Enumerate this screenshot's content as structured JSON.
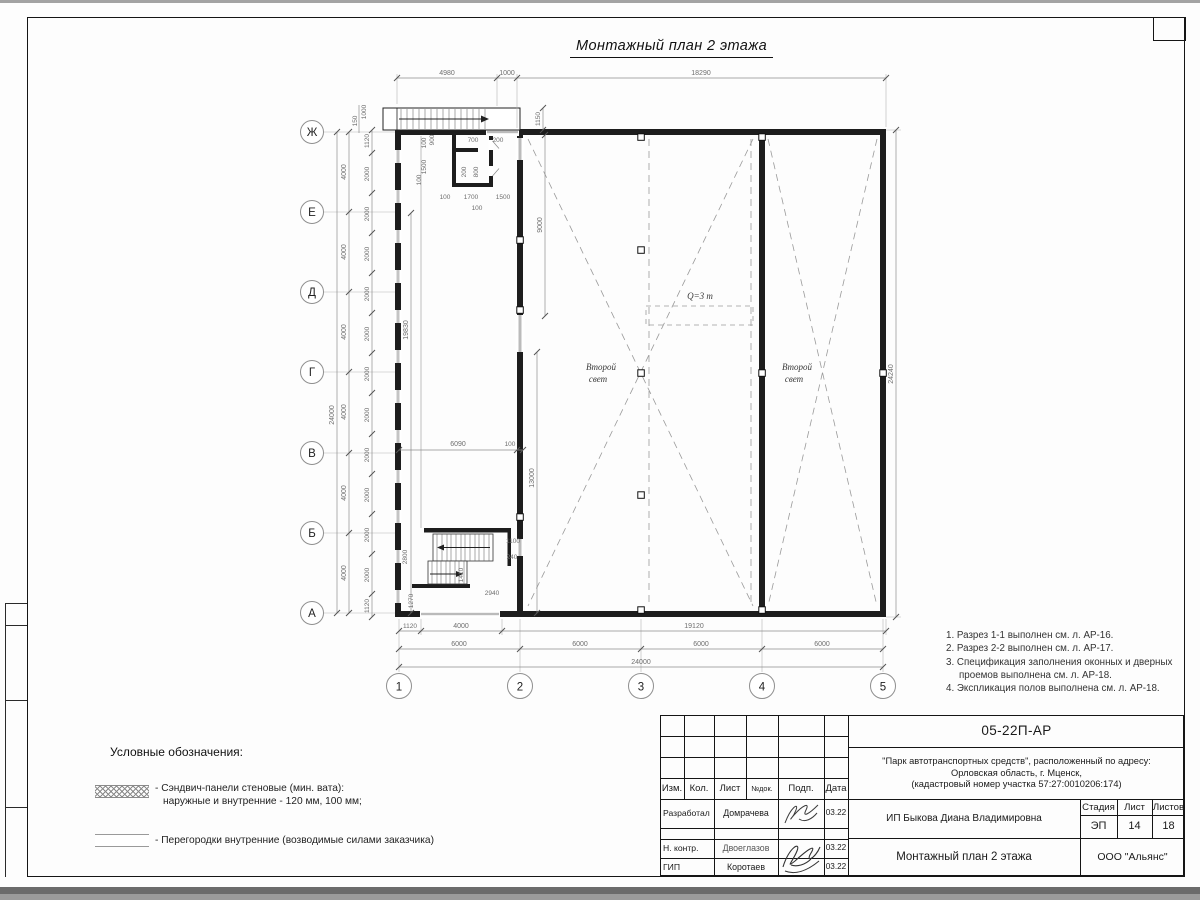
{
  "title": "Монтажный план 2 этажа",
  "notes": {
    "items": [
      "1. Разрез 1-1 выполнен см. л. АР-16.",
      "2. Разрез 2-2 выполнен см. л. АР-17.",
      "3. Спецификация заполнения оконных и дверных проемов выполнена см. л. АР-18.",
      "4. Экспликация полов выполнена см. л. АР-18."
    ]
  },
  "legend": {
    "title": "Условные обозначения:",
    "item1_line1": "- Сэндвич-панели стеновые (мин. вата):",
    "item1_line2": "наружные и внутренние - 120 мм, 100 мм;",
    "item2": "- Перегородки внутренние (возводимые силами заказчика)"
  },
  "plan": {
    "axes": {
      "rows": [
        "Ж",
        "Е",
        "Д",
        "Г",
        "В",
        "Б",
        "А"
      ],
      "cols": [
        "1",
        "2",
        "3",
        "4",
        "5"
      ]
    },
    "labels": {
      "second_light_line1": "Второй",
      "second_light_line2": "свет",
      "crane": "Q=3 т"
    },
    "dims": {
      "d4980": "4980",
      "d1000": "1000",
      "d18290": "18290",
      "d1150": "1150",
      "d150": "150",
      "d24000": "24000",
      "d4000": "4000",
      "d2000": "2000",
      "d1120": "1120",
      "d24240": "24240",
      "d19830": "19830",
      "d9000": "9000",
      "d13000": "13000",
      "d6090": "6090",
      "d100": "100",
      "d900": "900",
      "d1500": "1500",
      "d700": "700",
      "d200": "200",
      "d800": "800",
      "d1700": "1700",
      "d1100": "1100",
      "d240": "240",
      "d2800": "2800",
      "d1410": "1410",
      "d2940": "2940",
      "d1270": "1270",
      "d19120": "19120",
      "d6000": "6000"
    }
  },
  "titleblock": {
    "doc_number": "05-22П-АР",
    "project_line1": "\"Парк автотранспортных средств\",  расположенный по адресу:",
    "project_line2": "Орловская область, г. Мценск,",
    "project_line3": "(кадастровый номер участка 57:27:0010206:174)",
    "header": {
      "izm": "Изм.",
      "kol": "Кол.",
      "list": "Лист",
      "ndok": "№док.",
      "podp": "Подп.",
      "data": "Дата"
    },
    "rows": [
      {
        "role": "Разработал",
        "name": "Домрачева",
        "date": "03.22"
      },
      {
        "role": "Н. контр.",
        "name": "Двоеглазов",
        "date": "03.22"
      },
      {
        "role": "ГИП",
        "name": "Коротаев",
        "date": "03.22"
      }
    ],
    "client": "ИП Быкова Диана Владимировна",
    "stage_label": "Стадия",
    "sheet_label": "Лист",
    "sheets_label": "Листов",
    "stage": "ЭП",
    "sheet_no": "14",
    "sheets_total": "18",
    "drawing_title": "Монтажный план 2 этажа",
    "company": "ООО \"Альянс\""
  }
}
